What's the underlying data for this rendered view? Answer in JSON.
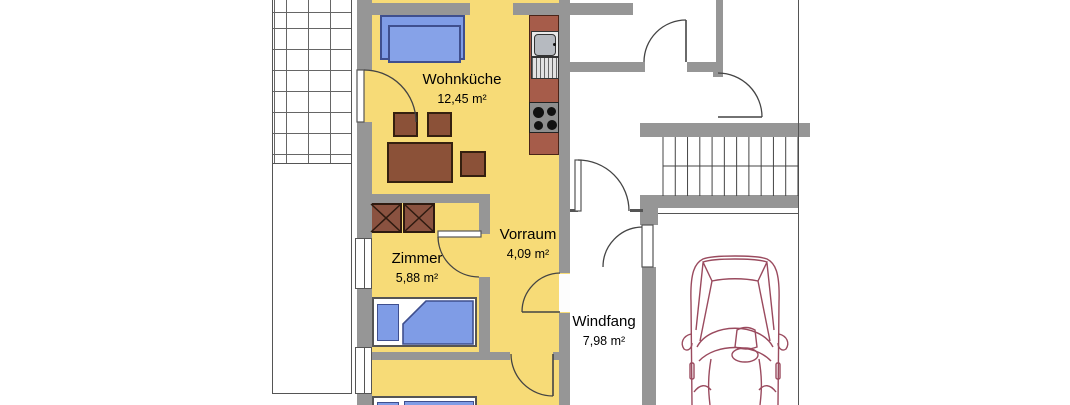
{
  "rooms": [
    {
      "name": "Wohnküche",
      "area": "12,45 m²"
    },
    {
      "name": "Zimmer",
      "area": "5,88 m²"
    },
    {
      "name": "Vorraum",
      "area": "4,09 m²"
    },
    {
      "name": "Windfang",
      "area": "7,98 m²"
    }
  ],
  "colors": {
    "floor": "#f7db77",
    "wall": "#969696",
    "furniture_wood": "#8b5138",
    "kitchen_counter": "#a65c4a",
    "upholstery": "#7f9ce6",
    "car_outline": "#9a4a5e"
  },
  "icons": {
    "stairs": "stairs-up-symbol",
    "car": "car-top-view",
    "terrace": "tiled-terrace",
    "sink": "kitchen-sink",
    "stove": "four-burner-stove",
    "wardrobe": "crossed-wardrobe-symbol"
  }
}
